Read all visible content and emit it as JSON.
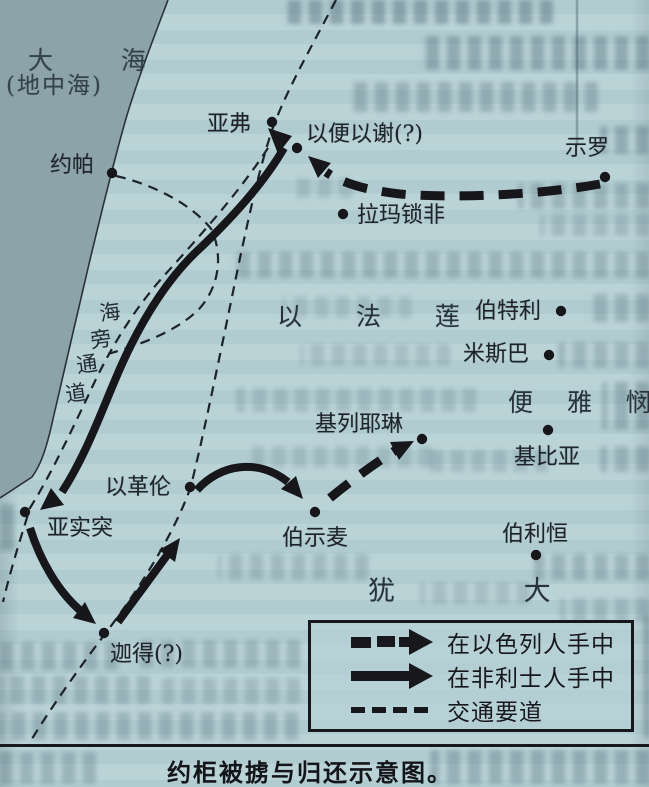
{
  "map": {
    "colors": {
      "page_bg": "#b6d1d5",
      "sea_fill": "#8da3aa",
      "ink": "#16161b",
      "road_ink": "#1c242a"
    },
    "sea": {
      "fill_path": "M0,0 L168,0 C152,42 136,84 125,122 C112,168 101,214 89,264 C76,318 62,382 50,432 C45,452 40,466 32,477 L0,498 Z",
      "coast_path": "M168,0 C152,42 136,84 125,122 C112,168 101,214 89,264 C76,318 62,382 50,432 C45,452 40,466 32,477 L0,498"
    },
    "routes": {
      "philistine": [
        {
          "d": "M284,148 C262,186 228,222 196,252 C166,281 142,320 122,364 C104,404 88,452 62,492"
        },
        {
          "d": "M30,528 C40,560 58,592 82,612"
        },
        {
          "d": "M118,622 C134,600 152,576 168,554"
        },
        {
          "d": "M197,490 C220,464 258,458 288,482"
        }
      ],
      "israelite": [
        {
          "d": "M600,184 C545,194 460,199 400,194 C365,190 342,183 326,172"
        },
        {
          "d": "M330,498 C352,480 374,464 396,450"
        }
      ],
      "roads": [
        {
          "d": "M336,0 C314,42 290,84 275,122 C261,160 250,212 240,258 C228,316 213,390 199,452 L191,486 C176,530 142,585 108,630 C82,664 52,706 30,742"
        },
        {
          "d": "M268,148 C238,194 198,238 162,278 C132,312 108,352 88,396 C70,434 50,476 30,508 C20,540 10,572 3,602"
        },
        {
          "d": "M116,176 C152,184 192,204 212,230 C223,257 219,286 200,308 C178,331 142,344 108,354"
        }
      ],
      "arrowheads": [
        {
          "points": "268,128 292,136 278,154"
        },
        {
          "points": "40,510 51,488 64,505"
        },
        {
          "points": "96,624 73,618 85,602"
        },
        {
          "points": "180,538 175,562 159,550"
        },
        {
          "points": "303,499 281,489 296,476"
        },
        {
          "points": "308,156 331,163 318,178"
        },
        {
          "points": "414,441 399,460 390,442"
        }
      ]
    },
    "cities": [
      {
        "name": "约帕",
        "dot": [
          112,
          173
        ],
        "label": [
          50,
          155
        ]
      },
      {
        "name": "亚弗",
        "dot": [
          272,
          122
        ],
        "label": [
          207,
          114
        ]
      },
      {
        "name": "以便以谢(?)",
        "dot": [
          297,
          148
        ],
        "label": [
          306,
          124
        ]
      },
      {
        "name": "示罗",
        "dot": [
          605,
          177
        ],
        "label": [
          565,
          138
        ]
      },
      {
        "name": "拉玛锁非",
        "dot": [
          343,
          214
        ],
        "label": [
          357,
          205
        ]
      },
      {
        "name": "伯特利",
        "dot": [
          561,
          311
        ],
        "label": [
          475,
          301
        ]
      },
      {
        "name": "米斯巴",
        "dot": [
          549,
          355
        ],
        "label": [
          463,
          344
        ]
      },
      {
        "name": "基比亚",
        "dot": [
          548,
          430
        ],
        "label": [
          514,
          447
        ]
      },
      {
        "name": "基列耶琳",
        "dot": [
          422,
          439
        ],
        "label": [
          315,
          414
        ]
      },
      {
        "name": "以革伦",
        "dot": [
          190,
          487
        ],
        "label": [
          105,
          477
        ]
      },
      {
        "name": "亚实突",
        "dot": [
          25,
          512
        ],
        "label": [
          47,
          518
        ]
      },
      {
        "name": "伯示麦",
        "dot": [
          315,
          512
        ],
        "label": [
          282,
          528
        ]
      },
      {
        "name": "迦得(?)",
        "dot": [
          104,
          633
        ],
        "label": [
          110,
          644
        ]
      },
      {
        "name": "伯利恒",
        "dot": [
          536,
          555
        ],
        "label": [
          502,
          524
        ]
      }
    ],
    "regions": [
      {
        "id": "sea-name",
        "text": "大 海",
        "x": 28,
        "y": 48,
        "fs": 25,
        "ls": 30,
        "sea": true
      },
      {
        "id": "sea-name-sub",
        "text": "(地中海)",
        "x": 6,
        "y": 75,
        "fs": 23,
        "ls": 2,
        "sea": true
      },
      {
        "id": "ephraim",
        "text": "以 法 莲",
        "x": 277,
        "y": 304,
        "fs": 25,
        "ls": 23,
        "sea": false
      },
      {
        "id": "benjamin",
        "text": "便 雅 悯",
        "x": 508,
        "y": 390,
        "fs": 25,
        "ls": 13,
        "sea": false
      },
      {
        "id": "judah",
        "text": "犹 大",
        "x": 368,
        "y": 578,
        "fs": 27,
        "ls": 60,
        "sea": false
      }
    ],
    "route_label": {
      "chars": [
        {
          "ch": "海",
          "x": 110,
          "y": 313
        },
        {
          "ch": "旁",
          "x": 101,
          "y": 340
        },
        {
          "ch": "通",
          "x": 87,
          "y": 365
        },
        {
          "ch": "道",
          "x": 76,
          "y": 394
        }
      ]
    },
    "legend": {
      "items": [
        {
          "symbol": "thick-dashed-arrow",
          "label": "在以色列人手中"
        },
        {
          "symbol": "thick-solid-arrow",
          "label": "在非利士人手中"
        },
        {
          "symbol": "thin-dashed-line",
          "label": "交通要道"
        }
      ]
    },
    "caption": "约柜被掳与归还示意图。",
    "bleed": [
      {
        "x": 285,
        "y": 0,
        "w": 268,
        "h": 24,
        "o": 0.45
      },
      {
        "x": 0,
        "y": 0,
        "w": 30,
        "h": 28,
        "o": 0.5
      },
      {
        "x": 0,
        "y": 30,
        "w": 20,
        "h": 36,
        "o": 0.45
      },
      {
        "x": 418,
        "y": 36,
        "w": 231,
        "h": 34,
        "o": 0.4
      },
      {
        "x": 348,
        "y": 82,
        "w": 250,
        "h": 30,
        "o": 0.33
      },
      {
        "x": 600,
        "y": 126,
        "w": 49,
        "h": 28,
        "o": 0.38
      },
      {
        "x": 296,
        "y": 178,
        "w": 56,
        "h": 20,
        "o": 0.2
      },
      {
        "x": 518,
        "y": 183,
        "w": 131,
        "h": 26,
        "o": 0.3
      },
      {
        "x": 540,
        "y": 214,
        "w": 109,
        "h": 22,
        "o": 0.24
      },
      {
        "x": 0,
        "y": 228,
        "w": 16,
        "h": 58,
        "o": 0.4
      },
      {
        "x": 230,
        "y": 252,
        "w": 419,
        "h": 26,
        "o": 0.3
      },
      {
        "x": 282,
        "y": 296,
        "w": 130,
        "h": 22,
        "o": 0.18
      },
      {
        "x": 586,
        "y": 294,
        "w": 63,
        "h": 28,
        "o": 0.3
      },
      {
        "x": 300,
        "y": 344,
        "w": 150,
        "h": 22,
        "o": 0.2
      },
      {
        "x": 558,
        "y": 342,
        "w": 91,
        "h": 26,
        "o": 0.28
      },
      {
        "x": 236,
        "y": 388,
        "w": 240,
        "h": 24,
        "o": 0.22
      },
      {
        "x": 602,
        "y": 382,
        "w": 47,
        "h": 48,
        "o": 0.34
      },
      {
        "x": 0,
        "y": 386,
        "w": 14,
        "h": 56,
        "o": 0.4
      },
      {
        "x": 252,
        "y": 446,
        "w": 180,
        "h": 22,
        "o": 0.2
      },
      {
        "x": 428,
        "y": 450,
        "w": 120,
        "h": 22,
        "o": 0.22
      },
      {
        "x": 600,
        "y": 446,
        "w": 49,
        "h": 26,
        "o": 0.3
      },
      {
        "x": 0,
        "y": 504,
        "w": 14,
        "h": 46,
        "o": 0.34
      },
      {
        "x": 218,
        "y": 554,
        "w": 150,
        "h": 26,
        "o": 0.24
      },
      {
        "x": 534,
        "y": 554,
        "w": 115,
        "h": 26,
        "o": 0.3
      },
      {
        "x": 420,
        "y": 582,
        "w": 110,
        "h": 22,
        "o": 0.2
      },
      {
        "x": 560,
        "y": 598,
        "w": 89,
        "h": 24,
        "o": 0.24
      },
      {
        "x": 644,
        "y": 616,
        "w": 5,
        "h": 122,
        "o": 0.4
      },
      {
        "x": 0,
        "y": 642,
        "w": 118,
        "h": 28,
        "o": 0.3
      },
      {
        "x": 140,
        "y": 640,
        "w": 160,
        "h": 28,
        "o": 0.28
      },
      {
        "x": 0,
        "y": 676,
        "w": 150,
        "h": 28,
        "o": 0.28
      },
      {
        "x": 162,
        "y": 678,
        "w": 138,
        "h": 26,
        "o": 0.24
      },
      {
        "x": 0,
        "y": 712,
        "w": 298,
        "h": 28,
        "o": 0.3
      },
      {
        "x": 430,
        "y": 750,
        "w": 219,
        "h": 34,
        "o": 0.34
      },
      {
        "x": 0,
        "y": 752,
        "w": 96,
        "h": 32,
        "o": 0.3
      }
    ]
  }
}
